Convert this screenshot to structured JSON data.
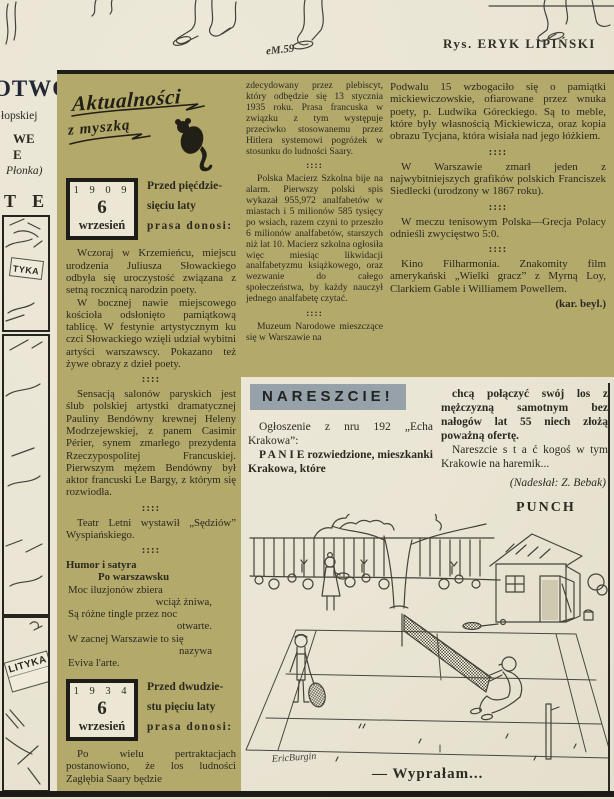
{
  "ui": {
    "separator": "::::"
  },
  "header": {
    "credit": "Rys. ERYK LIPIŃSKI",
    "artist_signature": "eM.59"
  },
  "margin_column": {
    "fragment_title": "OTWÓR",
    "fragment_line1": "łopskiej",
    "fragment_line2": "WE",
    "fragment_line3": "E",
    "fragment_line4": "Płonka)",
    "fragment_word": "T E K",
    "panel1_sign": "TYKA",
    "panel3_newspaper": "LITYKA"
  },
  "aktualnosci": {
    "logo_line1": "Aktualności",
    "logo_line2": "z myszką",
    "box1909": {
      "year": "1 9 0 9",
      "day": "6",
      "month": "wrzesień"
    },
    "intro1909": {
      "l1": "Przed pięćdzie-",
      "l2": "sięciu laty",
      "l3": "prasa donosi:"
    },
    "items_a": [
      {
        "type": "para",
        "text": "Wczoraj w Krzemieńcu, miejscu urodzenia Juliusza Słowackiego odbyła się uroczystość związana z setną rocznicą narodzin poety."
      },
      {
        "type": "para",
        "text": "W bocznej nawie miejscowego kościoła odsłonięto pamiątkową tablicę. W festynie artystycznym ku czci Słowackiego wzięli udział wybitni artyści warszawscy. Pokazano też żywe obrazy z dzieł poety."
      },
      {
        "type": "sep"
      },
      {
        "type": "para",
        "text": "Sensacją salonów paryskich jest ślub polskiej artystki dramatycznej Pauliny Bendówny krewnej Heleny Modrzejewskiej, z panem Casimir Périer, synem zmarłego prezydenta Rzeczypospolitej Francuskiej. Pierwszym mężem Bendówny był aktor francuski Le Bargy, z którym się rozwiodła."
      },
      {
        "type": "sep"
      },
      {
        "type": "para",
        "text": "Teatr Letni wystawił „Sędziów” Wyspiańskiego."
      },
      {
        "type": "sep"
      },
      {
        "type": "bold",
        "text": "Humor i satyra"
      },
      {
        "type": "boldc",
        "text": "Po warszawsku"
      },
      {
        "type": "poem",
        "text": "Moc iluzjonów zbiera"
      },
      {
        "type": "poemr",
        "text": "wciąż żniwa,"
      },
      {
        "type": "poem",
        "text": "Są różne tingle przez noc"
      },
      {
        "type": "poemr",
        "text": "otwarte."
      },
      {
        "type": "poem",
        "text": "W zacnej Warszawie to się"
      },
      {
        "type": "poemr",
        "text": "nazywa"
      },
      {
        "type": "poem",
        "text": "Eviva l'arte."
      }
    ],
    "box1934": {
      "year": "1 9 3 4",
      "day": "6",
      "month": "wrzesień"
    },
    "intro1934": {
      "l1": "Przed dwudzie-",
      "l2": "stu pięciu laty",
      "l3": "prasa donosi:"
    },
    "items_b": [
      {
        "type": "para",
        "text": "Po wielu pertraktacjach postanowiono, że los ludności Zagłębia Saary będzie"
      }
    ]
  },
  "column_middle": {
    "items": [
      {
        "type": "flush",
        "text": "zdecydowany przez plebiscyt, który odbędzie się 13 stycznia 1935 roku. Prasa francuska w związku z tym występuje przeciwko stosowanemu przez Hitlera systemowi pogróżek w stosunku do ludności Saary."
      },
      {
        "type": "sep"
      },
      {
        "type": "para",
        "text": "Polska Macierz Szkolna bije na alarm. Pierwszy polski spis wykazał 955,972 analfabetów w miastach i 5 milionów 585 tysięcy po wsiach, razem czyni to przeszło 6 milionów analfabetów, starszych niż lat 10. Macierz szkolna ogłosiła więc miesiąc likwidacji analfabetyzmu książkowego, oraz wezwanie do całego społeczeństwa, by każdy nauczył jednego analfabetę czytać."
      },
      {
        "type": "sep"
      },
      {
        "type": "para",
        "text": "Muzeum Narodowe mieszczące się w Warszawie na"
      }
    ]
  },
  "column_right": {
    "items": [
      {
        "type": "flush",
        "text": "Podwalu 15 wzbogaciło się o pamiątki mickiewiczowskie, ofiarowane przez wnuka poety, p. Ludwika Góreckiego. Są to meble, które były własnością Mickiewicza, oraz kopia obrazu Tycjana, która wisiała nad jego łóżkiem."
      },
      {
        "type": "sep"
      },
      {
        "type": "para",
        "text": "W Warszawie zmarł jeden z najwybitniejszych grafików polskich Franciszek Siedlecki (urodzony w 1867 roku)."
      },
      {
        "type": "sep"
      },
      {
        "type": "para",
        "text": "W meczu tenisowym Polska—Grecja Polacy odnieśli zwycięstwo 5:0."
      },
      {
        "type": "sep"
      },
      {
        "type": "para",
        "text": "Kino Filharmonia. Znakomity film amerykański „Wielki gracz” z Myrną Loy, Clarkiem Gable i Williamem Powellem."
      },
      {
        "type": "credit",
        "text": "(kar. beyl.)"
      }
    ]
  },
  "nareszcie": {
    "title": "NARESZCIE!",
    "left_items": [
      {
        "type": "para",
        "text": "Ogłoszenie z nru 192 „Echa Krakowa”:"
      },
      {
        "type": "pbold",
        "text": "P A N I E   rozwiedzione, mieszkanki Krakowa, które"
      }
    ],
    "right_items": [
      {
        "type": "pbold",
        "text": "chcą połączyć swój los z mężczyzną samotnym bez nałogów lat 55 niech złożą poważną ofertę."
      },
      {
        "type": "para",
        "text": "Nareszcie  s t a ć  kogoś w tym Krakowie na haremik..."
      },
      {
        "type": "crediti",
        "text": "(Nadesłał: Z. Bebak)"
      }
    ]
  },
  "punch": {
    "label": "PUNCH",
    "caption": "— Wyprałam...",
    "cartoonist_signature": "EricBurgin"
  },
  "colors": {
    "page": "#eae5d4",
    "olive": "#b3a96a",
    "highlight": "#97a1a9",
    "ink": "#2b2921"
  }
}
